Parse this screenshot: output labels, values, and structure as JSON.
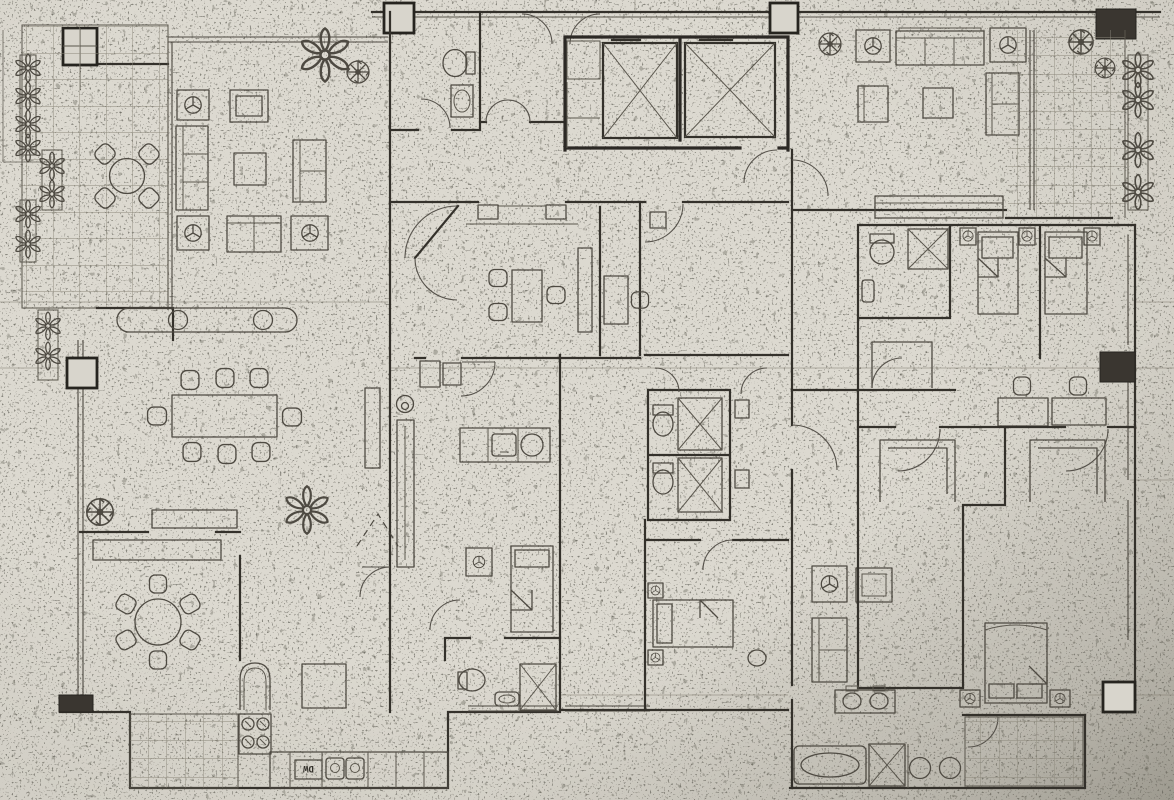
{
  "labels": {
    "dishwasher": "DW"
  },
  "palette": {
    "paper": "#d7d4cb",
    "paper_light": "#dedbd2",
    "shadow_edge": "#b3b0a6",
    "ink_wall": "#34312b",
    "ink_furniture": "#4e4a42",
    "tile_grid": "#8b877a"
  },
  "fixtures": [
    "balcony-tile-grid",
    "planter-flowers",
    "pinwheel-plant",
    "round-table-with-chairs",
    "sofa",
    "armchair-with-lamp-symbol",
    "coffee-table",
    "tv-cabinet",
    "sideboard",
    "elevator-shaft",
    "elevator-car",
    "toilet",
    "wash-basin",
    "shower-stall",
    "bathtub",
    "double-vanity",
    "single-bed",
    "double-bed",
    "nightstand-lamp",
    "dining-table-8-chairs",
    "round-dining-table-6-chairs",
    "wardrobe",
    "desk-with-chairs",
    "bay-window",
    "kitchen-counter",
    "cooktop-4-burner",
    "kitchen-sink",
    "double-sink",
    "dishwasher",
    "refrigerator",
    "kitchen-island",
    "door-swing",
    "dashed-door",
    "window",
    "column"
  ]
}
